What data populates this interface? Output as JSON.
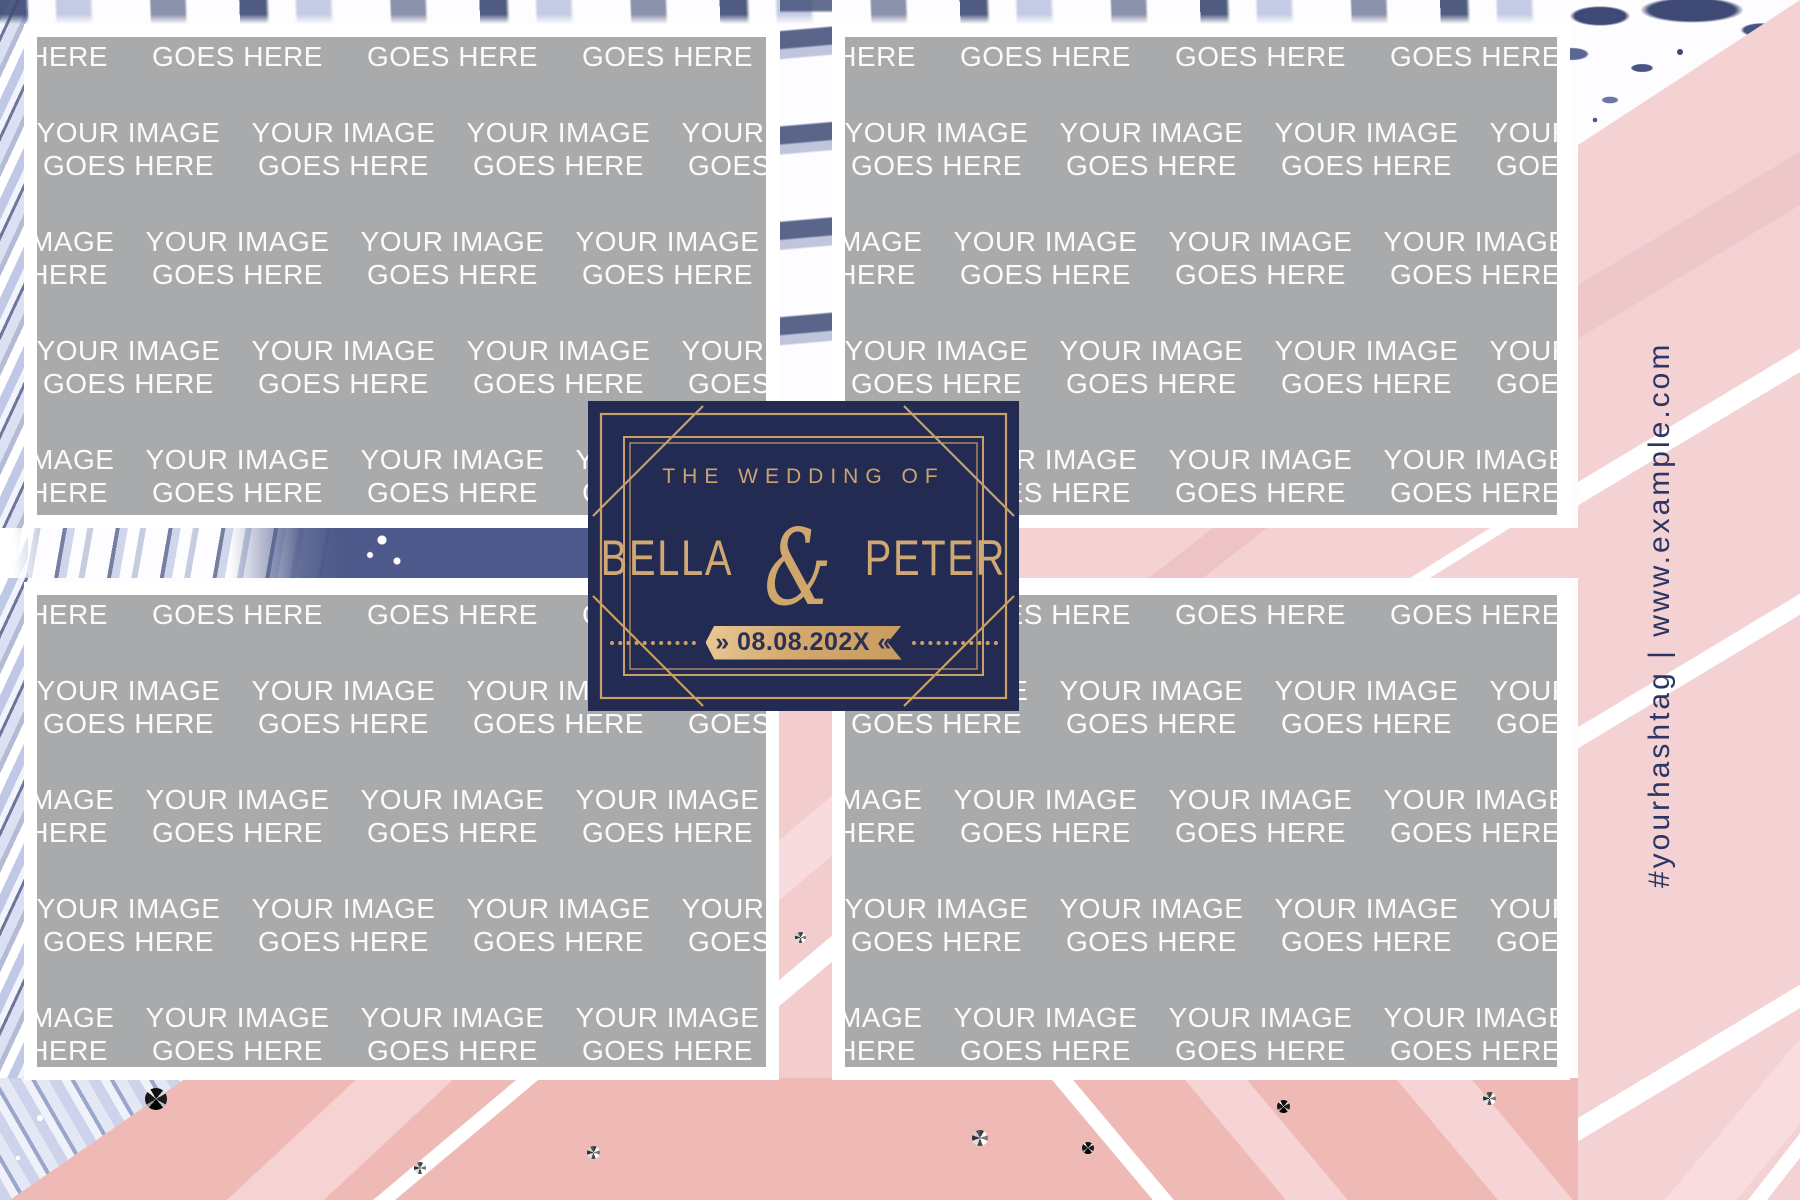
{
  "badge": {
    "eyebrow": "THE WEDDING OF",
    "bride": "BELLA",
    "ampersand": "&",
    "groom": "PETER",
    "date": "» 08.08.202X «"
  },
  "placeholder": {
    "line1": "YOUR IMAGE",
    "line2": "GOES HERE"
  },
  "sidebar": {
    "vertical_text": "#yourhashtag | www.example.com"
  },
  "colors": {
    "badge_navy": "#232b52",
    "gold": "#c9a067",
    "placeholder_gray": "#a8aaab",
    "pink_light": "#f4d2d3",
    "pink_deep": "#efb9b6",
    "marble_navy": "#3e4a75",
    "marble_lavender": "#bcc5e4",
    "text_navy": "#2c3563"
  }
}
